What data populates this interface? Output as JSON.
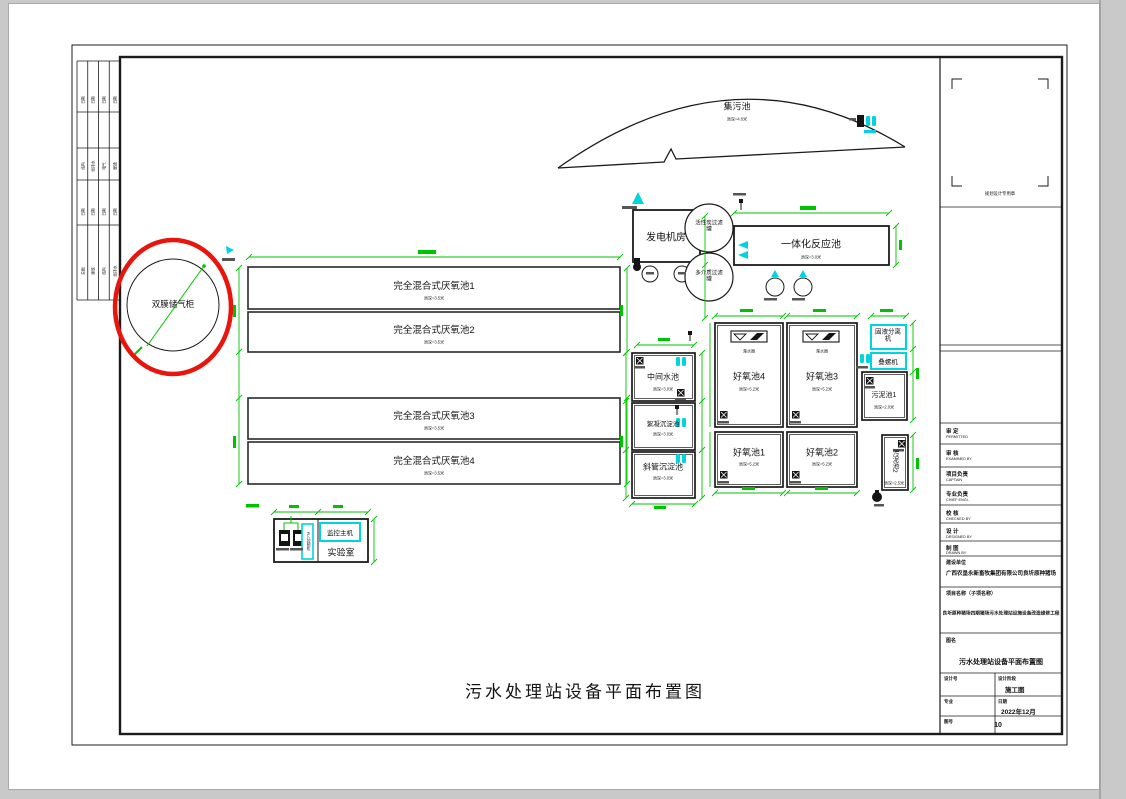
{
  "main_title": "污水处理站设备平面布置图",
  "stamp_caption": "规划设计专用章",
  "units": {
    "gas_holder": "双膜储气柜",
    "sump": {
      "name": "集污池",
      "depth": "池深=4.0米"
    },
    "generator": "发电机房",
    "filter_top": "活性炭过滤罐",
    "filter_bottom": "多介质过滤罐",
    "integrated": {
      "name": "一体化反应池",
      "depth": "池深=3.0米"
    },
    "anaerobic": [
      {
        "name": "完全混合式厌氧池1",
        "depth": "池深=3.5米"
      },
      {
        "name": "完全混合式厌氧池2",
        "depth": "池深=3.5米"
      },
      {
        "name": "完全混合式厌氧池3",
        "depth": "池深=3.5米"
      },
      {
        "name": "完全混合式厌氧池4",
        "depth": "池深=3.5米"
      }
    ],
    "middle_pool": {
      "name": "中间水池",
      "depth": "池深=3.0米"
    },
    "floc_pool": {
      "name": "絮凝沉淀池",
      "depth": "池深=3.0米"
    },
    "inclined_pool": {
      "name": "斜管沉淀池",
      "depth": "池深=3.0米"
    },
    "aerobic": [
      {
        "name": "好氧池1",
        "depth": "池深=5.2米"
      },
      {
        "name": "好氧池2",
        "depth": "池深=5.2米"
      },
      {
        "name": "好氧池3",
        "depth": "池深=5.2米"
      },
      {
        "name": "好氧池4",
        "depth": "池深=5.2米"
      }
    ],
    "decanter": "滗水器",
    "separator": "固液分离机",
    "screw_press": "叠螺机",
    "sludge1": {
      "name": "污泥池1",
      "depth": "池深=2.0米"
    },
    "sludge2": {
      "name": "污泥池2",
      "depth": "池深=2.5米"
    },
    "monitor_host": "监控主机",
    "laboratory": "实验室",
    "control_cabinet": "PLC控制柜"
  },
  "signature_strip": {
    "rows": [
      [
        "日期",
        "日期",
        "日期",
        "日期"
      ],
      [
        "结构",
        "给排水",
        "电气",
        "暖通"
      ],
      [
        "日期",
        "日期",
        "日期",
        "日期"
      ],
      [
        "总图",
        "建筑",
        "结构",
        "给排水"
      ]
    ]
  },
  "title_block": {
    "roles": [
      {
        "cn": "审  定",
        "en": "PERMITTED"
      },
      {
        "cn": "审  核",
        "en": "EXAMINED BY"
      },
      {
        "cn": "项目负责",
        "en": "CAPTAIN"
      },
      {
        "cn": "专业负责",
        "en": "CHIEF ENGI."
      },
      {
        "cn": "校  核",
        "en": "CHECKED BY"
      },
      {
        "cn": "设  计",
        "en": "DESIGNED BY"
      },
      {
        "cn": "制  图",
        "en": "DRAWN BY"
      }
    ],
    "owner_label": "建设单位",
    "owner": "广西农垦永新畜牧集团有限公司良圻原种猪场",
    "project_label": "项目名称（子项名称）",
    "project": "良圻原种猪场四期猪场污水处理站设施设备改造维修工程",
    "figure_label": "图名",
    "figure_name": "污水处理站设备平面布置图",
    "design_no_label": "设计号",
    "stage_label": "设计阶段",
    "stage": "施工图",
    "major_label": "专业",
    "date_label": "日期",
    "date": "2022年12月",
    "sheet_label": "图号",
    "sheet": "10"
  }
}
